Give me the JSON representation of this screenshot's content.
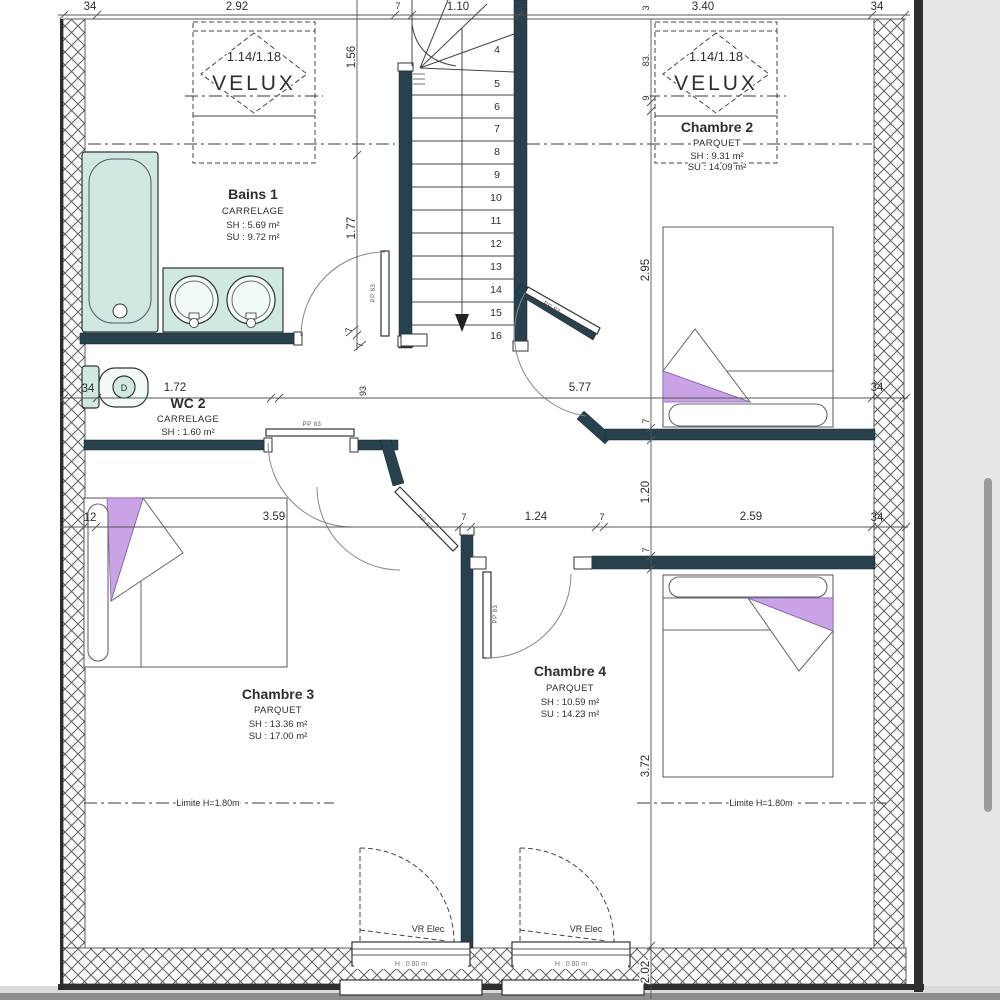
{
  "rooms": {
    "bains1": {
      "name": "Bains 1",
      "floor": "CARRELAGE",
      "sh": "SH : 5.69 m²",
      "su": "SU : 9.72 m²"
    },
    "wc2": {
      "name": "WC 2",
      "floor": "CARRELAGE",
      "sh": "SH : 1.60 m²"
    },
    "chambre2": {
      "name": "Chambre 2",
      "floor": "PARQUET",
      "sh": "SH : 9.31 m²",
      "su": "SU : 14.09 m²"
    },
    "chambre3": {
      "name": "Chambre 3",
      "floor": "PARQUET",
      "sh": "SH : 13.36 m²",
      "su": "SU : 17.00 m²"
    },
    "chambre4": {
      "name": "Chambre 4",
      "floor": "PARQUET",
      "sh": "SH : 10.59 m²",
      "su": "SU : 14.23 m²"
    }
  },
  "velux": {
    "size": "1.14/1.18",
    "brand": "VELUX"
  },
  "stairs": {
    "steps": [
      "4",
      "5",
      "6",
      "7",
      "8",
      "9",
      "10",
      "11",
      "12",
      "13",
      "14",
      "15",
      "16"
    ]
  },
  "dims": {
    "top": [
      "34",
      "2.92",
      "7",
      "1.10",
      "7",
      "3.40",
      "34"
    ],
    "mid": [
      "34",
      "1.72",
      "93",
      "5.77",
      "34"
    ],
    "low": [
      "12",
      "3.59",
      "7",
      "1.24",
      "7",
      "2.59",
      "34"
    ],
    "v156": "1.56",
    "v177": "1.77",
    "v295": "2.95",
    "v120": "1.20",
    "v372": "3.72",
    "v202": "2.02",
    "v83": "83.",
    "v9": "9",
    "v3": "3",
    "v7": "7"
  },
  "labels": {
    "door": "PP 83",
    "limit": "Limite H=1.80m",
    "window": "VR Elec",
    "window_height": "H : 0.80 m",
    "toilet": "D"
  },
  "colors": {
    "wall": "#27424e",
    "fixture": "#cfe8e2",
    "bed": "#c9a3e5"
  }
}
